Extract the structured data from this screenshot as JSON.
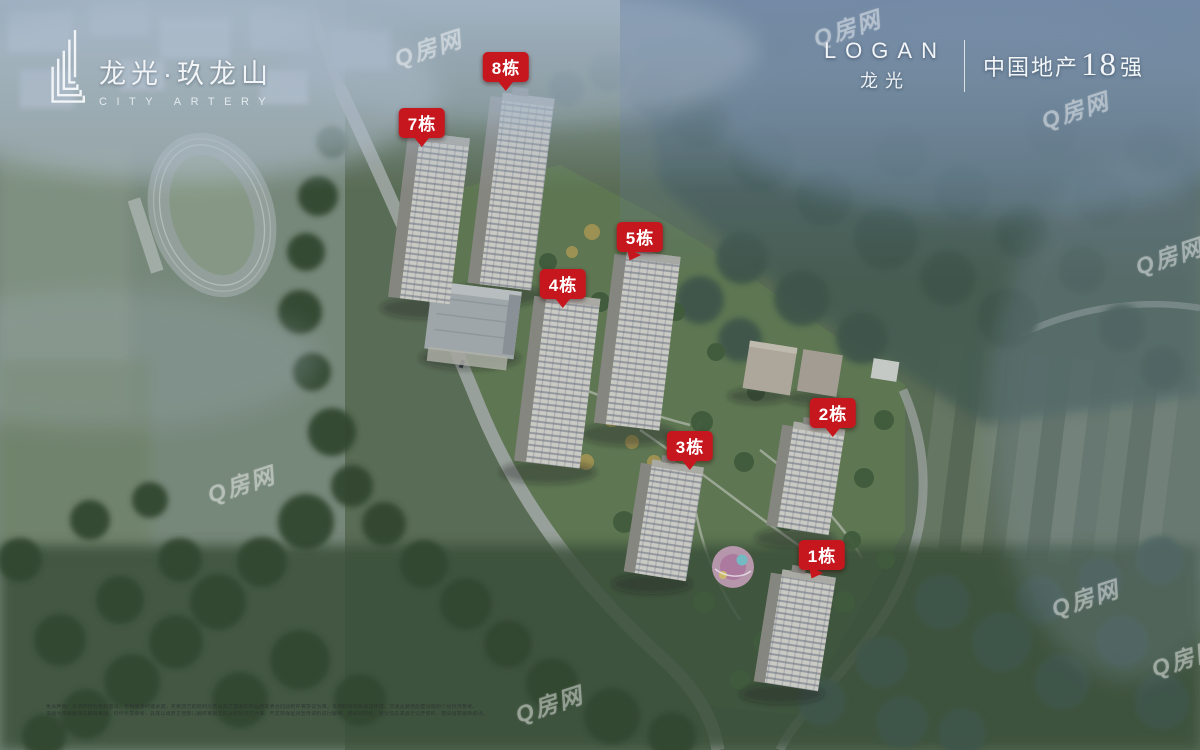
{
  "brand": {
    "name_cn": "龙光·玖龙山",
    "name_en": "CITY ARTERY",
    "icon": "building-logo-icon"
  },
  "developer": {
    "name_en": "LOGAN",
    "name_cn": "龙光",
    "rank_prefix": "中国地产",
    "rank_number": "18",
    "rank_suffix": "强"
  },
  "building_labels": [
    {
      "text": "8栋",
      "x": 506,
      "y": 67,
      "dir": "down"
    },
    {
      "text": "7栋",
      "x": 422,
      "y": 123,
      "dir": "down"
    },
    {
      "text": "5栋",
      "x": 640,
      "y": 237,
      "dir": "down-left"
    },
    {
      "text": "4栋",
      "x": 563,
      "y": 284,
      "dir": "down"
    },
    {
      "text": "3栋",
      "x": 690,
      "y": 446,
      "dir": "down"
    },
    {
      "text": "2栋",
      "x": 833,
      "y": 413,
      "dir": "down"
    },
    {
      "text": "1栋",
      "x": 822,
      "y": 555,
      "dir": "down-left"
    }
  ],
  "watermark": {
    "text": "Q房网",
    "positions": [
      {
        "x": 393,
        "y": 30
      },
      {
        "x": 812,
        "y": 10
      },
      {
        "x": 1040,
        "y": 92
      },
      {
        "x": 1134,
        "y": 238
      },
      {
        "x": 206,
        "y": 466
      },
      {
        "x": 1050,
        "y": 580
      },
      {
        "x": 514,
        "y": 686
      },
      {
        "x": 1150,
        "y": 640
      }
    ]
  },
  "disclaimer": {
    "line1": "免责声明：本资料仅为要约邀请，不构成要约或承诺，买卖双方的权利义务以双方签署的商品房买卖合同及附件等协议为准，本资料对项目周边环境、交通及其他配套设施的介绍仅供参考。",
    "line2": "本图为项目整体鸟瞰效果图，仅作示意参考，具体以政府主管部门最终审批文件及实际交付为准，开发商保留对宣传资料进行解释、修改的权利，部分信息来源于公开资料，敬请留意最新资讯。"
  },
  "colors": {
    "label_bg": "#c6171e",
    "label_text": "#ffffff",
    "watermark": "rgba(255,255,255,0.38)"
  }
}
